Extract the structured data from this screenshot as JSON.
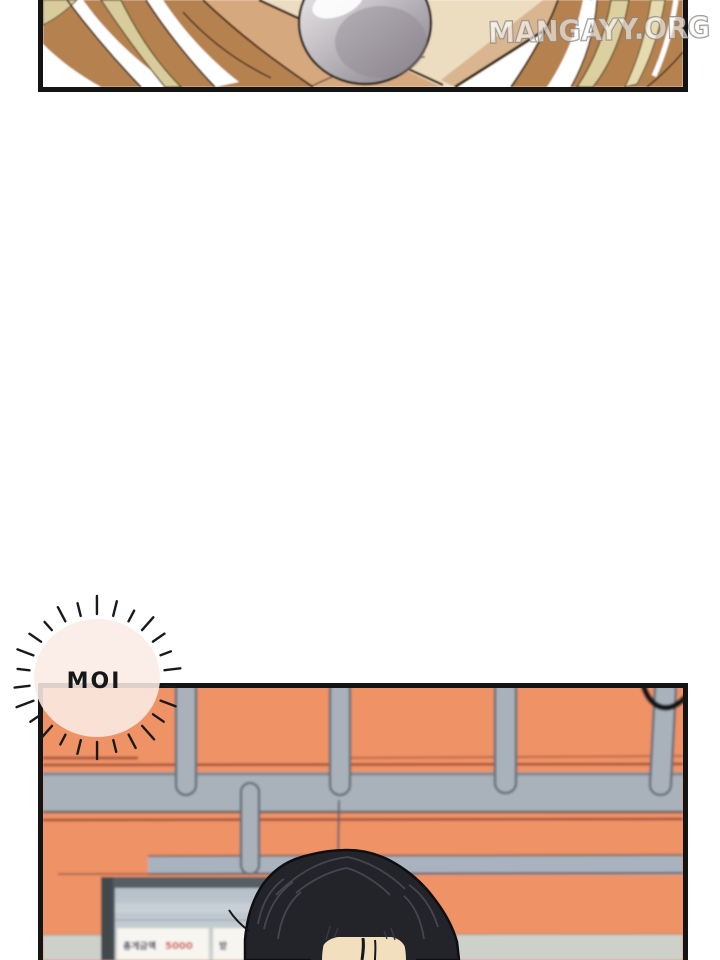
{
  "watermark": {
    "text": "MANGAYY.ORG"
  },
  "speech_bubble": {
    "text": "MOI"
  },
  "monitor": {
    "sign_primary_dark": "총게금액",
    "sign_primary_red": "5000",
    "sign_secondary": "받"
  },
  "colors": {
    "panel_border": "#141414",
    "wall_orange": "#ef9266",
    "seam_red": "#a0503a",
    "rail_gray": "#a9b2bb",
    "mid_rail_gray": "#a9b3bf",
    "floor_band": "#cdd1ca",
    "hair_black": "#232429",
    "skin": "#f1dfbe",
    "screen_gray": "#c2ccd2",
    "sign_red_text": "#cf4840",
    "bubble_fill": "#fbece5",
    "hair_brown": "#b5814f",
    "hair_blonde": "#d9cc9c",
    "oval_gray": "#c9c5c9"
  }
}
